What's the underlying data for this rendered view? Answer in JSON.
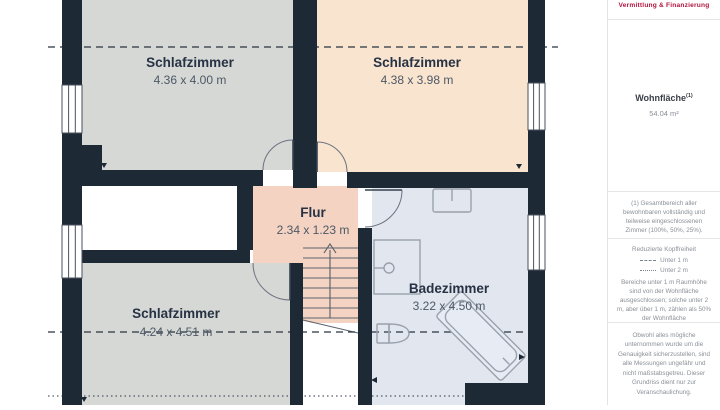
{
  "plan": {
    "rooms": {
      "bedroom_top_left": {
        "name": "Schlafzimmer",
        "dims": "4.36 x 4.00 m"
      },
      "bedroom_top_right": {
        "name": "Schlafzimmer",
        "dims": "4.38 x 3.98 m"
      },
      "bedroom_bottom_left": {
        "name": "Schlafzimmer",
        "dims": "4.24 x 4.51 m"
      },
      "hallway": {
        "name": "Flur",
        "dims": "2.34 x 1.23 m"
      },
      "bathroom": {
        "name": "Badezimmer",
        "dims": "3.22 x 4.50 m"
      }
    },
    "colors": {
      "wall": "#1e2936",
      "room_gray": "#d6d8d5",
      "room_peach": "#f9e4cf",
      "hallway_salmon": "#f4d3c2",
      "bathroom_blue": "#e2e6ef",
      "line_dark": "#2a3442"
    }
  },
  "sidebar": {
    "brand_tagline": "Vermittlung & Finanzierung",
    "brand_color": "#b2153c",
    "area_label": "Wohnfläche",
    "area_label_sup": "(1)",
    "area_value": "54.04 m²",
    "footnote": "(1) Gesamtbereich aller bewohnbaren vollständig und teilweise eingeschlossenen Zimmer (100%, 50%, 25%).",
    "legend": {
      "title": "Reduzierte Kopffreiheit",
      "items": [
        {
          "style": "dashed",
          "label": "Unter 1 m"
        },
        {
          "style": "dotted",
          "label": "Unter 2 m"
        }
      ],
      "note": "Bereiche unter 1 m Raumhöhe sind von der Wohnfläche ausgeschlossen; solche unter 2 m, aber über 1 m, zählen als 50% der Wohnfläche"
    },
    "disclaimer": "Obwohl alles mögliche unternommen wurde um die Genauigkeit sicherzustellen, sind alle Messungen ungefähr und nicht maßstabsgetreu. Dieser Grundriss dient nur zur Veranschaulichung."
  }
}
